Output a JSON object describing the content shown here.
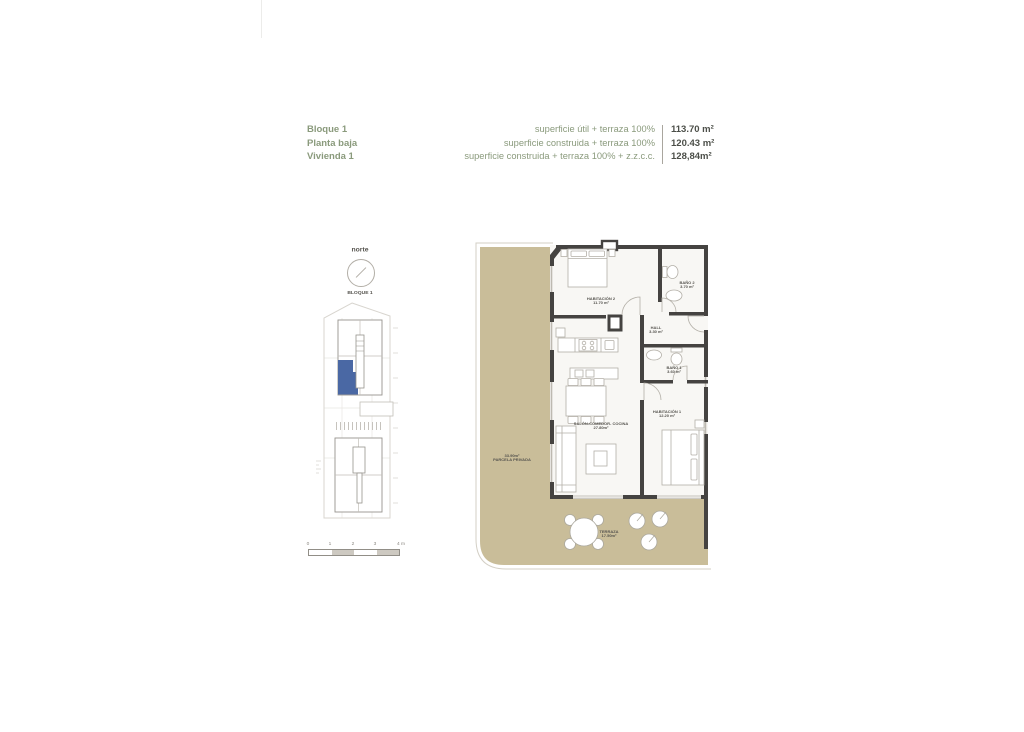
{
  "header": {
    "block": "Bloque 1",
    "floor": "Planta baja",
    "unit": "Vivienda 1",
    "metrics": [
      {
        "label": "superficie útil + terraza 100%",
        "value": "113.70 m²"
      },
      {
        "label": "superficie construida + terraza 100%",
        "value": "120.43 m²"
      },
      {
        "label": "superficie construida + terraza 100% + z.z.c.c.",
        "value": "128,84m²"
      }
    ]
  },
  "site_plan": {
    "north_label": "norte",
    "block_label": "BLOQUE 1",
    "scale_ticks": [
      "0",
      "1",
      "2",
      "3",
      "4 m"
    ]
  },
  "floor_plan": {
    "rooms": [
      {
        "name": "HABITACIÓN 2",
        "area": "11.70 m²"
      },
      {
        "name": "BAÑO 2",
        "area": "3.70 m²"
      },
      {
        "name": "HALL",
        "area": "3.30 m²"
      },
      {
        "name": "BAÑO 1",
        "area": "3.60 m²"
      },
      {
        "name": "HABITACIÓN 1",
        "area": "12.20 m²"
      },
      {
        "name": "SALÓN-COMEDOR- COCINA",
        "area": "27.80m²"
      },
      {
        "name": "TERRAZA",
        "area": "17.50m²"
      },
      {
        "name": "PARCELA PRIVADA",
        "area": "33.90m²"
      }
    ]
  },
  "colors": {
    "terrain": "#c9bd99",
    "wall": "#454341",
    "unit_highlight": "#4a68a4",
    "accent_green": "#8a9a7c"
  }
}
